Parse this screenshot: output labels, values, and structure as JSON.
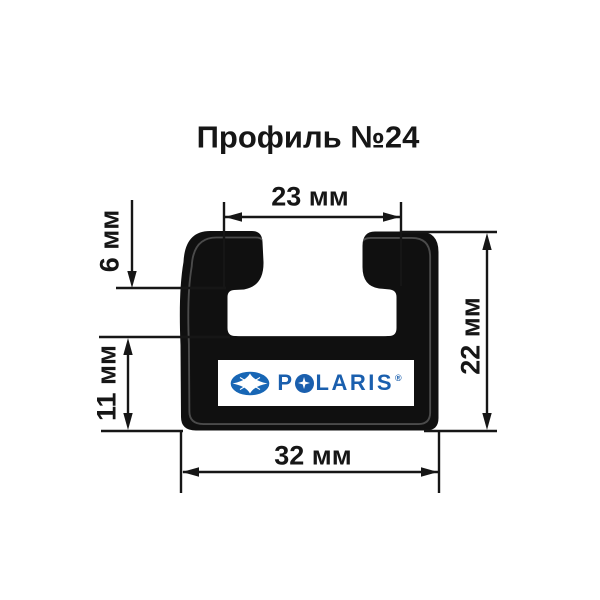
{
  "title": "Профиль №24",
  "dimensions": {
    "top_inner_width": "23 мм",
    "lip_height": "6 мм",
    "lower_wall_height": "11 мм",
    "overall_height": "22 мм",
    "bottom_width": "32 мм"
  },
  "logo": {
    "wordmark_full": "POLARIS",
    "wordmark_first": "P",
    "wordmark_rest": "LARIS",
    "registered": "®"
  },
  "colors": {
    "background": "#ffffff",
    "profile_fill": "#101010",
    "line": "#161616",
    "inner_contour": "#4b4b4b",
    "polaris_blue": "#1a5fae",
    "badge_blue": "#1766b5"
  },
  "icons": {
    "badge": "polaris-ellipse-star-icon",
    "wordmark_o": "four-point-star-icon"
  }
}
